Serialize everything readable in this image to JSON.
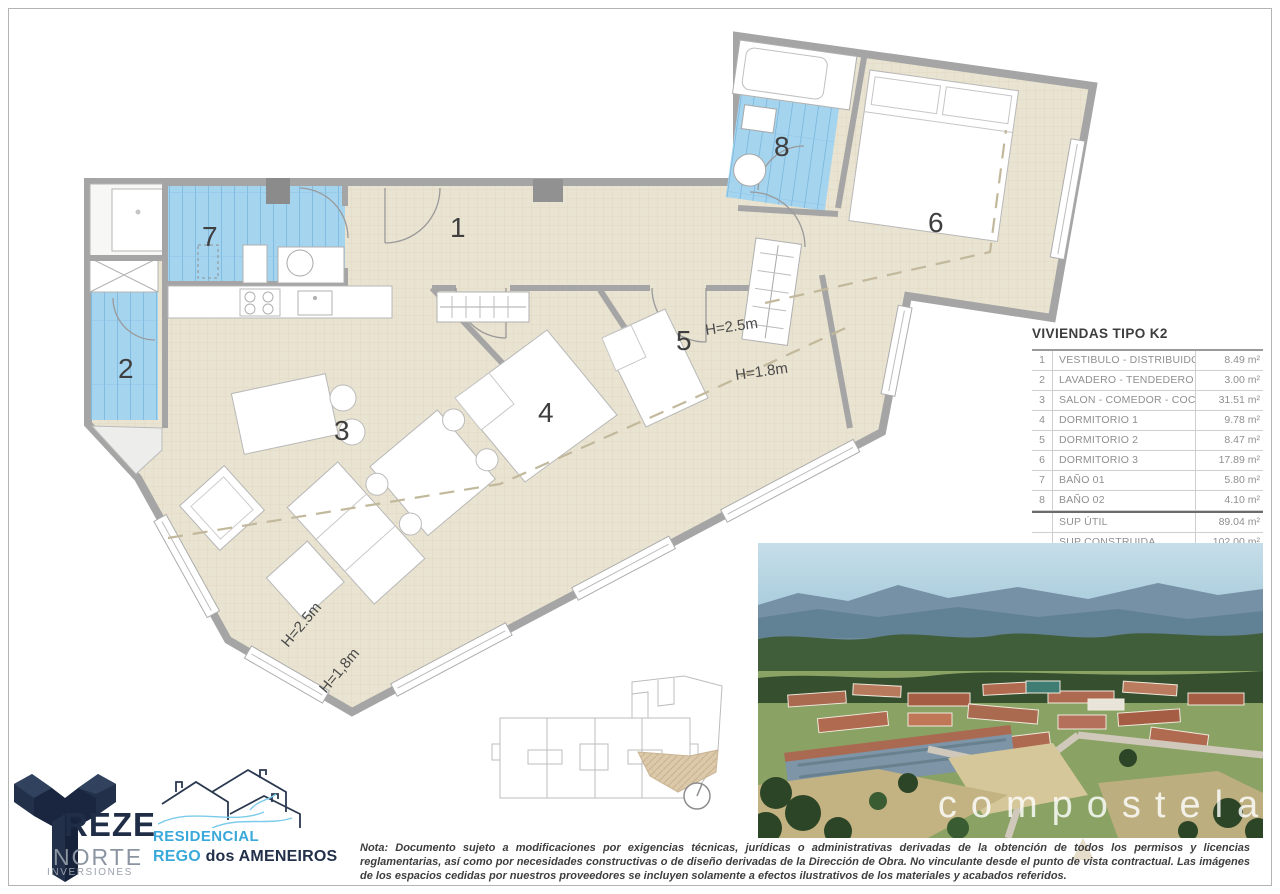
{
  "area_table": {
    "title": "VIVIENDAS TIPO K2",
    "rows": [
      {
        "num": "1",
        "name": "VESTIBULO - DISTRIBUIDOR",
        "area": "8.49 m²"
      },
      {
        "num": "2",
        "name": "LAVADERO - TENDEDERO",
        "area": "3.00 m²"
      },
      {
        "num": "3",
        "name": "SALON - COMEDOR - COCINA",
        "area": "31.51 m²"
      },
      {
        "num": "4",
        "name": "DORMITORIO 1",
        "area": "9.78 m²"
      },
      {
        "num": "5",
        "name": "DORMITORIO 2",
        "area": "8.47 m²"
      },
      {
        "num": "6",
        "name": "DORMITORIO 3",
        "area": "17.89 m²"
      },
      {
        "num": "7",
        "name": "BAÑO 01",
        "area": "5.80 m²"
      },
      {
        "num": "8",
        "name": "BAÑO 02",
        "area": "4.10 m²"
      }
    ],
    "summary": [
      {
        "name": "SUP ÚTIL",
        "area": "89.04 m²"
      },
      {
        "name": "SUP CONSTRUIDA",
        "area": "102.00 m²"
      }
    ]
  },
  "plan": {
    "rooms": [
      "1",
      "2",
      "3",
      "4",
      "5",
      "6",
      "7",
      "8"
    ],
    "height_labels": [
      "H=2.5m",
      "H=1.8m",
      "H=2.5m",
      "H=1,8m"
    ]
  },
  "photo": {
    "watermark": "compostela"
  },
  "logos": {
    "treze": {
      "word": "REZE",
      "line2": "NORTE",
      "line3": "INVERSIONES"
    },
    "residencial": {
      "line1": "RESIDENCIAL",
      "line2_accent": "REGO",
      "line2_rest": " dos AMENEIROS"
    }
  },
  "note": {
    "text": "Nota: Documento sujeto a modificaciones por exigencias técnicas, jurídicas o administrativas derivadas de la obtención de todos los permisos y licencias reglamentarias, así como por necesidades constructivas o de diseño derivadas de la Dirección de Obra. No vinculante desde el punto de vista contractual. Las imágenes de los espacios cedidas por nuestros proveedores se incluyen solamente a efectos ilustrativos de los materiales y acabados referidos."
  },
  "colors": {
    "floor": "#e9e3d1",
    "tile_blue": "#a5d4ef",
    "wall_gray": "#a5a5a5",
    "brand_navy": "#22304a",
    "brand_blue": "#3aa9da"
  }
}
